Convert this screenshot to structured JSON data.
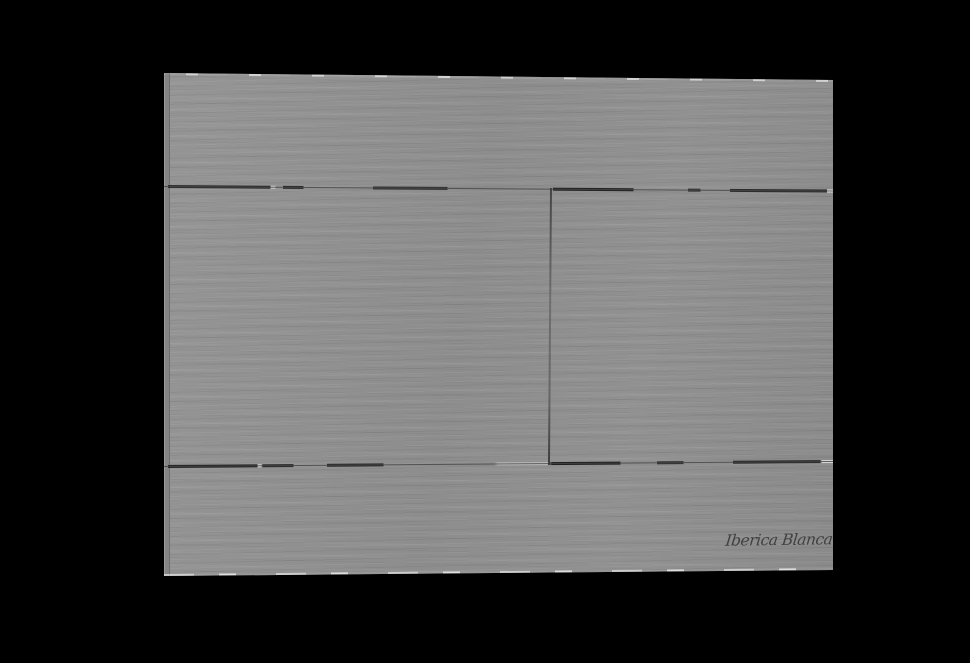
{
  "product": {
    "brand_signature": "Iberica Blanca"
  },
  "plate": {
    "panels": {
      "top_panel": "",
      "bottom_panel": "",
      "left_button": "",
      "right_button": ""
    }
  },
  "colors": {
    "background": "#000000",
    "plate_base": "#8f8f8f",
    "plate_side_edge": "#848484",
    "seam_dark": "#1c1c1c",
    "seam_hairline": "#464646",
    "edge_highlight": "#ffffff",
    "signature_ink": "#3a3a3a"
  }
}
